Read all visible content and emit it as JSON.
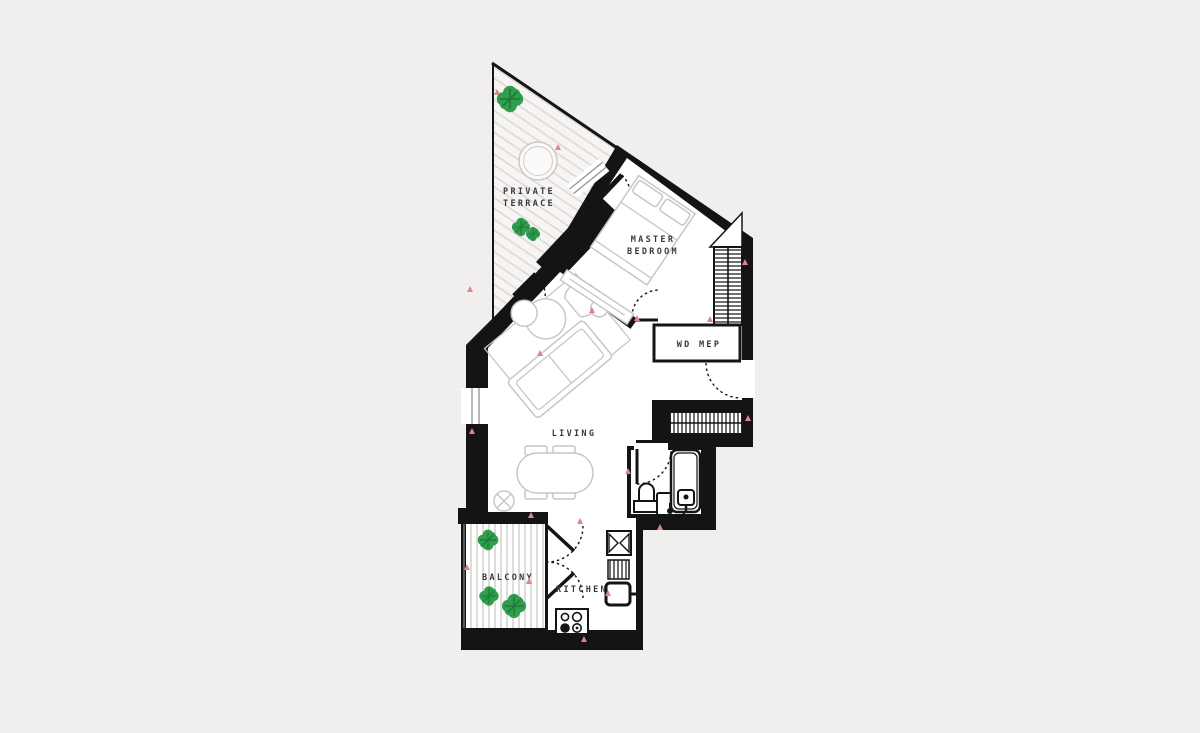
{
  "meta": {
    "title": "Apartment floor plan with private terrace"
  },
  "palette": {
    "background": "#f0efee",
    "floor": "#ffffff",
    "wall": "#141414",
    "hatch": "#dcd7d4",
    "deck": "#d8d4d1",
    "furniture": "#c9c6c3",
    "plant_green": "#2f9e4f",
    "plant_dark": "#1f7a39",
    "marker_pink": "#e0848a",
    "label": "#3a3a3a"
  },
  "rooms": {
    "terrace": {
      "label_line1": "PRIVATE",
      "label_line2": "TERRACE"
    },
    "master_bedroom": {
      "label_line1": "MASTER",
      "label_line2": "BEDROOM"
    },
    "wd_mep": {
      "label": "WD MEP"
    },
    "living": {
      "label": "LIVING"
    },
    "balcony": {
      "label": "BALCONY"
    },
    "kitchen": {
      "label": "KITCHEN"
    }
  },
  "fixtures": [
    "terrace-table",
    "plant",
    "bed",
    "wardrobe",
    "hall-closet",
    "console",
    "sofa",
    "coffee-table",
    "armchair",
    "side-table",
    "dining-table",
    "dining-chair",
    "floor-drain",
    "toilet",
    "washbasin",
    "bathtub",
    "kitchen-sink",
    "dishwasher",
    "oven",
    "hob",
    "entry-door",
    "interior-door",
    "double-door",
    "window",
    "dimension-marker"
  ]
}
